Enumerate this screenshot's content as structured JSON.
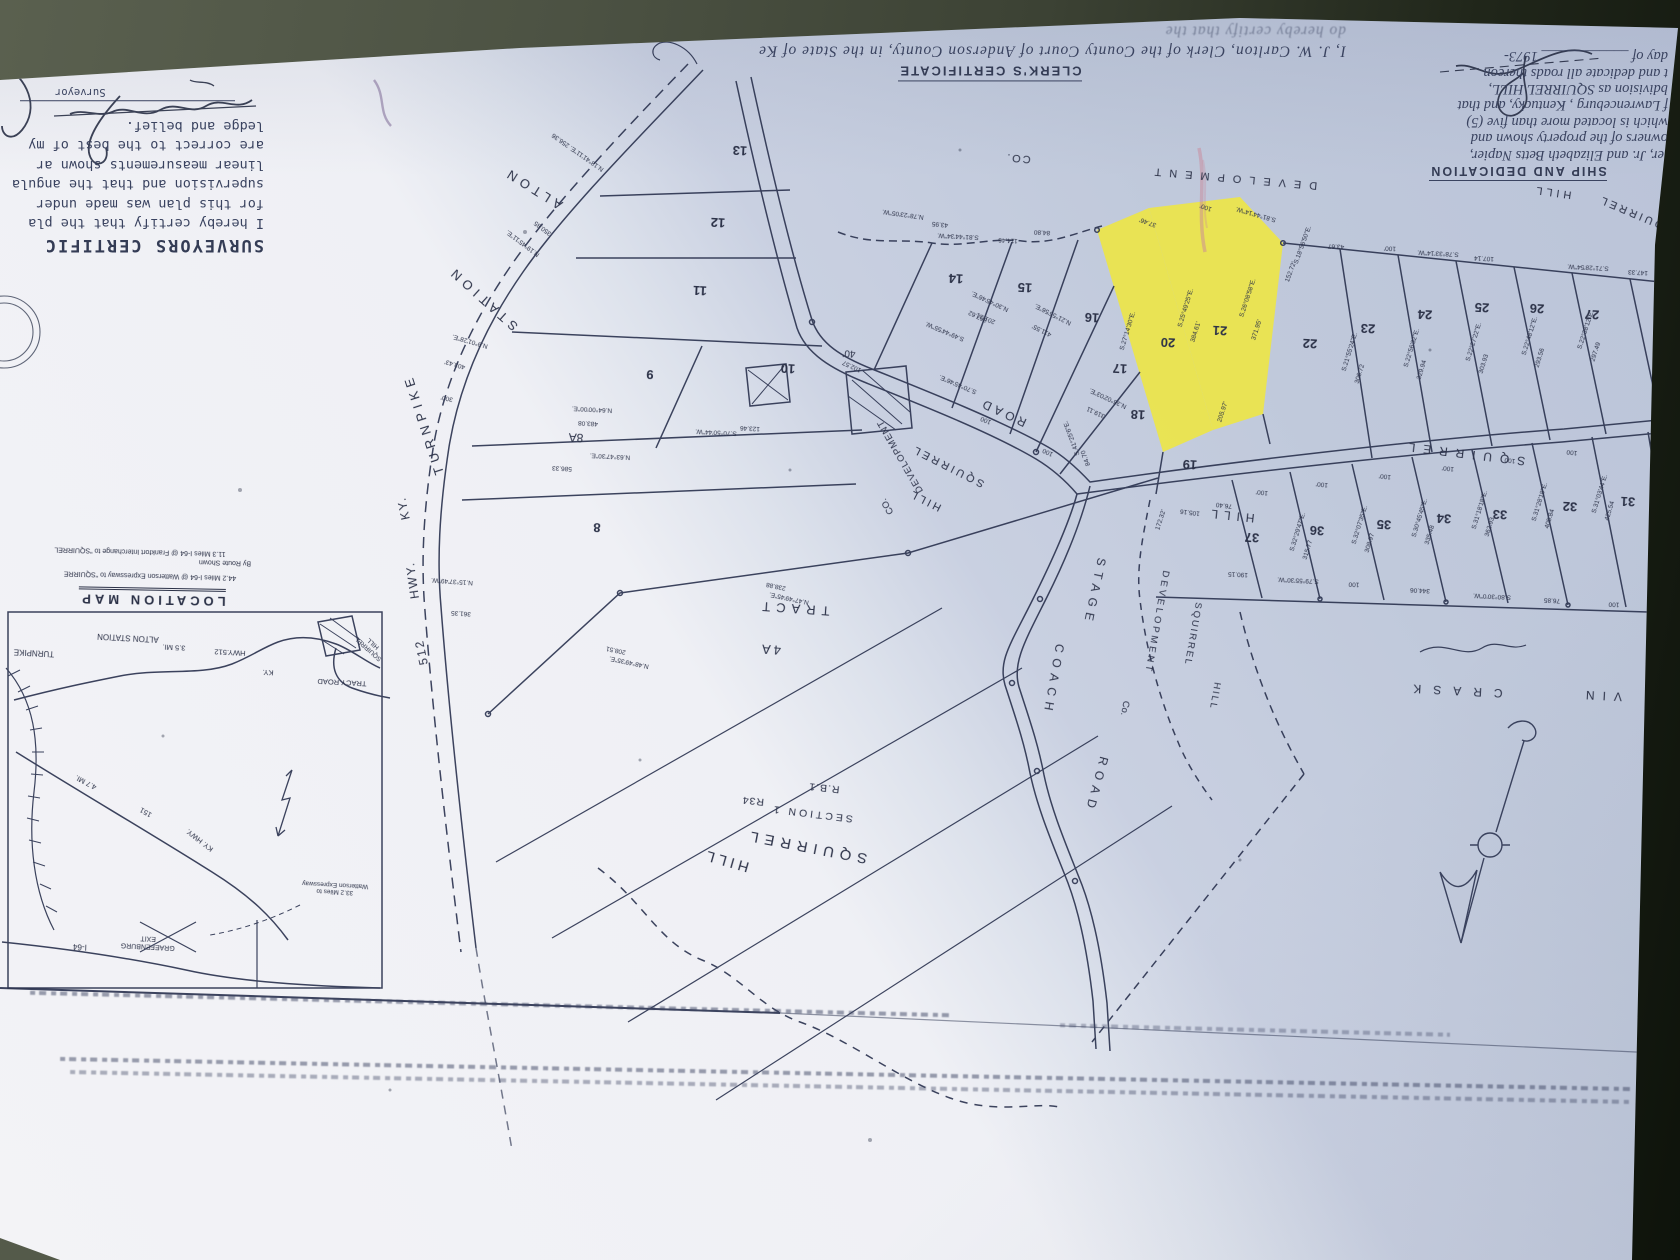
{
  "colors": {
    "paper_light": "#f3f3f6",
    "paper_shadow": "#bac3d8",
    "ink": "#2b3147",
    "highlight": "#f0e83c",
    "background_olive": "#4c5243",
    "pink_mark": "#c9879a",
    "purple_mark": "#7d6a96"
  },
  "certificates": {
    "surveyor": {
      "heading": "SURVEYORS CERTIFIC",
      "lines": [
        "I hereby certify that the pla",
        "for this plan was made under",
        "supervision and that the angula",
        "linear measurements shown ar",
        "are correct to the best of my",
        "ledge and belief."
      ],
      "signature_label": "Surveyor"
    },
    "clerk": {
      "heading": "CLERK'S CERTIFICATE",
      "lines": [
        "I, J. W. Carlton, Clerk of the County Court of Anderson County, in the State of Ke",
        "do hereby certify that the"
      ]
    },
    "dedication": {
      "heading": "SHIP AND DEDICATION",
      "lines": [
        "ler, Jr. and Elizabeth Betts Napier,",
        "owners of the property shown and",
        "which is located more than five (5)",
        "f Lawrenceburg , Kentucky, and that",
        "bdivision as SQUIRREL HILL,",
        "t and dedicate all roads thereon"
      ],
      "date_line": "day of ____________ 1973-"
    }
  },
  "location_map": {
    "labels": [
      {
        "t": "LOCATION MAP",
        "x": 152,
        "y": 597,
        "r": 181,
        "s": 13,
        "sp": 4,
        "b": 1,
        "u": 1,
        "dn": "location-map-title"
      },
      {
        "t": "11.3 Miles I-64 @ Frankfort Interchange to \"SQUIRREL",
        "x": 140,
        "y": 551,
        "r": 181.5,
        "s": 7
      },
      {
        "t": "By Route Shown",
        "x": 225,
        "y": 562,
        "r": 181.5,
        "s": 7
      },
      {
        "t": "44.2 Miles I-64 @ Watterson Expressway to \"SQUIRRE",
        "x": 150,
        "y": 575,
        "r": 181.5,
        "s": 7
      },
      {
        "t": "TURNPIKE",
        "x": 34,
        "y": 652,
        "s": 8
      },
      {
        "t": "ALTON STATION",
        "x": 128,
        "y": 637,
        "s": 8
      },
      {
        "t": "3.5 MI.",
        "x": 174,
        "y": 647,
        "s": 7.5
      },
      {
        "t": "HWY.512",
        "x": 230,
        "y": 652,
        "s": 7.5
      },
      {
        "t": "KY.",
        "x": 268,
        "y": 672,
        "s": 7.5
      },
      {
        "t": "TRACY ROAD",
        "x": 342,
        "y": 682,
        "s": 7.5
      },
      {
        "t": "SQUIRREL\nHILL",
        "x": 371,
        "y": 646,
        "r": 222,
        "s": 6.5,
        "nl": 1
      },
      {
        "t": "KY. HWY.",
        "x": 200,
        "y": 840,
        "r": 218,
        "s": 7.5
      },
      {
        "t": "151",
        "x": 146,
        "y": 812,
        "r": 210,
        "s": 7.5
      },
      {
        "t": "4.7 MI.",
        "x": 86,
        "y": 782,
        "r": 208,
        "s": 7.5
      },
      {
        "t": "I-64",
        "x": 80,
        "y": 946,
        "s": 8
      },
      {
        "t": "GRAEFENBURG\nEXIT",
        "x": 148,
        "y": 942,
        "s": 7,
        "nl": 1
      },
      {
        "t": "33.2 Miles to\nWatterson Expressway",
        "x": 335,
        "y": 888,
        "s": 6.5,
        "nl": 1
      }
    ]
  },
  "plat": {
    "highlighted_lots": [
      "20",
      "21"
    ],
    "labels": [
      {
        "t": "ALTON",
        "x": 533,
        "y": 188,
        "r": 212,
        "s": 13,
        "sp": 5
      },
      {
        "t": "STATION",
        "x": 483,
        "y": 298,
        "r": 222,
        "s": 13,
        "sp": 5
      },
      {
        "t": "TURNPIKE",
        "x": 424,
        "y": 424,
        "r": 252,
        "s": 13,
        "sp": 5
      },
      {
        "t": "KY.",
        "x": 404,
        "y": 508,
        "r": 258,
        "s": 12,
        "sp": 2
      },
      {
        "t": "HWY.",
        "x": 413,
        "y": 580,
        "r": 262,
        "s": 12,
        "sp": 2
      },
      {
        "t": "512",
        "x": 422,
        "y": 652,
        "r": 258,
        "s": 12,
        "sp": 2
      },
      {
        "t": "ROAD",
        "x": 1003,
        "y": 412,
        "r": 205,
        "s": 12,
        "sp": 4
      },
      {
        "t": "SQUIRREL",
        "x": 948,
        "y": 466,
        "r": 207,
        "s": 11,
        "sp": 3
      },
      {
        "t": "HILL",
        "x": 925,
        "y": 500,
        "r": 207,
        "s": 11,
        "sp": 3
      },
      {
        "t": "DEVELOPMENT",
        "x": 901,
        "y": 456,
        "r": 240,
        "s": 9.5,
        "sp": 1
      },
      {
        "t": "CO.",
        "x": 888,
        "y": 506,
        "r": 240,
        "s": 9.5
      },
      {
        "t": "STAGE",
        "x": 1094,
        "y": 592,
        "r": 102,
        "s": 12,
        "sp": 6
      },
      {
        "t": "COACH",
        "x": 1053,
        "y": 680,
        "r": 100,
        "s": 12,
        "sp": 6
      },
      {
        "t": "ROAD",
        "x": 1096,
        "y": 785,
        "r": 105,
        "s": 12,
        "sp": 6
      },
      {
        "t": "SQUIRREL",
        "x": 1463,
        "y": 453,
        "r": 187,
        "s": 12,
        "sp": 8
      },
      {
        "t": "HILL",
        "x": 1230,
        "y": 515,
        "r": 186,
        "s": 12,
        "sp": 6
      },
      {
        "t": "DEVELOPMENT",
        "x": 1156,
        "y": 622,
        "r": 100,
        "s": 9.5,
        "sp": 3
      },
      {
        "t": "Co.",
        "x": 1124,
        "y": 708,
        "r": 100,
        "s": 9.5
      },
      {
        "t": "SQUIRREL",
        "x": 1192,
        "y": 634,
        "r": 100,
        "s": 9.5,
        "sp": 2
      },
      {
        "t": "HILL",
        "x": 1214,
        "y": 696,
        "r": 100,
        "s": 9.5,
        "sp": 2
      },
      {
        "t": "DEVELOPMENT",
        "x": 1232,
        "y": 178,
        "r": 185,
        "s": 11,
        "sp": 8
      },
      {
        "t": "CO.",
        "x": 1018,
        "y": 158,
        "r": 185,
        "s": 11,
        "sp": 2
      },
      {
        "t": "HILL",
        "x": 1552,
        "y": 192,
        "r": 188,
        "s": 11,
        "sp": 4
      },
      {
        "t": "SQUIRREL",
        "x": 1636,
        "y": 214,
        "r": 203,
        "s": 11,
        "sp": 3
      },
      {
        "t": "CRASK",
        "x": 1452,
        "y": 690,
        "r": 183,
        "s": 12,
        "sp": 12
      },
      {
        "t": "VIN",
        "x": 1600,
        "y": 695,
        "r": 183,
        "s": 12,
        "sp": 8
      },
      {
        "t": "TRACT",
        "x": 793,
        "y": 608,
        "r": 184,
        "s": 13,
        "sp": 6
      },
      {
        "t": "4A",
        "x": 770,
        "y": 649,
        "r": 184,
        "s": 13,
        "sp": 3
      },
      {
        "t": "SQUIRREL",
        "x": 806,
        "y": 846,
        "r": 191,
        "s": 15,
        "sp": 6,
        "dn": "subdivision-title"
      },
      {
        "t": "HILL",
        "x": 726,
        "y": 860,
        "r": 196,
        "s": 15,
        "sp": 4,
        "dn": "subdivision-title"
      },
      {
        "t": "SECTION 1",
        "x": 812,
        "y": 813,
        "r": 187,
        "s": 10.5,
        "sp": 3
      },
      {
        "t": "R.B.1",
        "x": 824,
        "y": 787,
        "r": 186,
        "s": 10.5,
        "sp": 1
      },
      {
        "t": "R34",
        "x": 753,
        "y": 800,
        "r": 186,
        "s": 10.5,
        "sp": 1
      },
      {
        "t": "40'",
        "x": 849,
        "y": 353,
        "r": 184,
        "s": 10
      },
      {
        "t": "8A",
        "x": 576,
        "y": 437,
        "r": 183,
        "s": 12
      }
    ],
    "lots": [
      {
        "n": "8",
        "x": 597,
        "y": 527
      },
      {
        "n": "9",
        "x": 650,
        "y": 374
      },
      {
        "n": "10",
        "x": 788,
        "y": 368
      },
      {
        "n": "11",
        "x": 700,
        "y": 290
      },
      {
        "n": "12",
        "x": 718,
        "y": 222
      },
      {
        "n": "13",
        "x": 740,
        "y": 150
      },
      {
        "n": "14",
        "x": 956,
        "y": 278
      },
      {
        "n": "15",
        "x": 1025,
        "y": 287
      },
      {
        "n": "16",
        "x": 1092,
        "y": 317
      },
      {
        "n": "17",
        "x": 1120,
        "y": 368
      },
      {
        "n": "18",
        "x": 1138,
        "y": 414
      },
      {
        "n": "19",
        "x": 1190,
        "y": 464
      },
      {
        "n": "20",
        "x": 1168,
        "y": 342
      },
      {
        "n": "21",
        "x": 1220,
        "y": 330
      },
      {
        "n": "22",
        "x": 1310,
        "y": 343
      },
      {
        "n": "23",
        "x": 1368,
        "y": 328
      },
      {
        "n": "24",
        "x": 1425,
        "y": 314
      },
      {
        "n": "25",
        "x": 1482,
        "y": 307
      },
      {
        "n": "26",
        "x": 1537,
        "y": 308
      },
      {
        "n": "27",
        "x": 1592,
        "y": 314
      },
      {
        "n": "31",
        "x": 1628,
        "y": 501
      },
      {
        "n": "32",
        "x": 1570,
        "y": 506
      },
      {
        "n": "33",
        "x": 1500,
        "y": 514
      },
      {
        "n": "34",
        "x": 1444,
        "y": 518
      },
      {
        "n": "35",
        "x": 1384,
        "y": 524
      },
      {
        "n": "36",
        "x": 1317,
        "y": 530
      },
      {
        "n": "37",
        "x": 1252,
        "y": 537
      }
    ],
    "bearings": [
      {
        "t": "N.19°45'11\"E.",
        "x": 523,
        "y": 243,
        "r": 217
      },
      {
        "t": "350.85",
        "x": 543,
        "y": 228,
        "r": 217
      },
      {
        "t": "N.9°01'28\"E.",
        "x": 470,
        "y": 341,
        "r": 196
      },
      {
        "t": "403.43'",
        "x": 455,
        "y": 364,
        "r": 196
      },
      {
        "t": "300'",
        "x": 447,
        "y": 398,
        "r": 193
      },
      {
        "t": "N.15°37'49\"W.",
        "x": 452,
        "y": 581,
        "r": 184
      },
      {
        "t": "361.35",
        "x": 461,
        "y": 613,
        "r": 184
      },
      {
        "t": "N.18°41'11\"E. 256.36",
        "x": 578,
        "y": 152,
        "r": 215
      },
      {
        "t": "N.64°00'00\"E.",
        "x": 592,
        "y": 409
      },
      {
        "t": "483.08",
        "x": 588,
        "y": 423
      },
      {
        "t": "586.33",
        "x": 562,
        "y": 468
      },
      {
        "t": "N.63°47'30\"E.",
        "x": 610,
        "y": 456
      },
      {
        "t": "N.47°49'45\"E.",
        "x": 789,
        "y": 598,
        "r": 192
      },
      {
        "t": "238.88",
        "x": 776,
        "y": 586,
        "r": 192
      },
      {
        "t": "N.48°49'35\"E.",
        "x": 629,
        "y": 662,
        "r": 192
      },
      {
        "t": "208.51",
        "x": 616,
        "y": 650,
        "r": 192
      },
      {
        "t": "S.70°50'44\"W.",
        "x": 716,
        "y": 432
      },
      {
        "t": "123.46",
        "x": 750,
        "y": 428
      },
      {
        "t": "S.81°44'34\"W.",
        "x": 958,
        "y": 236
      },
      {
        "t": "114.46",
        "x": 1008,
        "y": 240
      },
      {
        "t": "N.78°23'05\"W.",
        "x": 903,
        "y": 214,
        "r": 188
      },
      {
        "t": "43.95",
        "x": 940,
        "y": 224,
        "r": 186
      },
      {
        "t": "84.80",
        "x": 1042,
        "y": 232
      },
      {
        "t": "37.46'",
        "x": 1148,
        "y": 222,
        "r": 200
      },
      {
        "t": "100'",
        "x": 1206,
        "y": 207,
        "r": 200
      },
      {
        "t": "S.81°44'14\"W.",
        "x": 1256,
        "y": 214,
        "r": 196
      },
      {
        "t": "152.72'",
        "x": 1291,
        "y": 272,
        "r": 290
      },
      {
        "t": "S.18°56'50\"E.",
        "x": 1303,
        "y": 245,
        "r": 290
      },
      {
        "t": "S.25°49'25\"E.",
        "x": 1186,
        "y": 308,
        "r": 287
      },
      {
        "t": "384.61'",
        "x": 1196,
        "y": 332,
        "r": 287
      },
      {
        "t": "S.26°08'58\"E.",
        "x": 1248,
        "y": 298,
        "r": 288
      },
      {
        "t": "371.95'",
        "x": 1257,
        "y": 330,
        "r": 288
      },
      {
        "t": "S.27°14'30\"E.",
        "x": 1128,
        "y": 331,
        "r": 287
      },
      {
        "t": "205.97'",
        "x": 1223,
        "y": 412,
        "r": 288
      },
      {
        "t": "172.32'",
        "x": 1161,
        "y": 520,
        "r": 288
      },
      {
        "t": "S.78°33'14\"W.",
        "x": 1438,
        "y": 253
      },
      {
        "t": "107.14",
        "x": 1484,
        "y": 258
      },
      {
        "t": "100'",
        "x": 1390,
        "y": 248
      },
      {
        "t": "43.67",
        "x": 1336,
        "y": 246
      },
      {
        "t": "S.71°28'54\"W.",
        "x": 1588,
        "y": 267
      },
      {
        "t": "147.33",
        "x": 1638,
        "y": 272
      },
      {
        "t": "S.21°55'24\"E.",
        "x": 1350,
        "y": 352,
        "r": 287
      },
      {
        "t": "306.72",
        "x": 1360,
        "y": 374,
        "r": 287
      },
      {
        "t": "S.22°56'32\"E.",
        "x": 1412,
        "y": 348,
        "r": 287
      },
      {
        "t": "329.94",
        "x": 1422,
        "y": 370,
        "r": 287
      },
      {
        "t": "S.22°27'22\"E.",
        "x": 1474,
        "y": 342,
        "r": 287
      },
      {
        "t": "303.93",
        "x": 1484,
        "y": 364,
        "r": 287
      },
      {
        "t": "S.22°48'12\"E.",
        "x": 1530,
        "y": 336,
        "r": 287
      },
      {
        "t": "293.56",
        "x": 1540,
        "y": 358,
        "r": 287
      },
      {
        "t": "S.22°38'12\"E.",
        "x": 1586,
        "y": 330,
        "r": 288
      },
      {
        "t": "297.49",
        "x": 1596,
        "y": 352,
        "r": 288
      },
      {
        "t": "N.30°45'46\"E.",
        "x": 990,
        "y": 301,
        "r": 205
      },
      {
        "t": "367.62",
        "x": 978,
        "y": 316,
        "r": 205
      },
      {
        "t": "N.21°55'56\"E.",
        "x": 1053,
        "y": 314,
        "r": 207
      },
      {
        "t": "411.55'",
        "x": 1042,
        "y": 330,
        "r": 207
      },
      {
        "t": "N.36°02'03\"E.",
        "x": 1108,
        "y": 398,
        "r": 205
      },
      {
        "t": "319.11",
        "x": 1096,
        "y": 412,
        "r": 205
      },
      {
        "t": "S.70°45'46\"E.",
        "x": 958,
        "y": 384,
        "r": 203
      },
      {
        "t": "100",
        "x": 986,
        "y": 420,
        "r": 203
      },
      {
        "t": "100",
        "x": 1048,
        "y": 452,
        "r": 205
      },
      {
        "t": "S.41°25'6\"E.",
        "x": 1072,
        "y": 438,
        "r": 250
      },
      {
        "t": "84.70",
        "x": 1086,
        "y": 458,
        "r": 250
      },
      {
        "t": "S.49°44'55\"W.",
        "x": 945,
        "y": 331,
        "r": 203
      },
      {
        "t": "201.31",
        "x": 986,
        "y": 318,
        "r": 203
      },
      {
        "t": "102.57",
        "x": 852,
        "y": 366,
        "r": 205
      },
      {
        "t": "100'",
        "x": 1262,
        "y": 492,
        "r": 187
      },
      {
        "t": "100'",
        "x": 1322,
        "y": 484,
        "r": 187
      },
      {
        "t": "100'",
        "x": 1385,
        "y": 476,
        "r": 187
      },
      {
        "t": "100'",
        "x": 1448,
        "y": 468,
        "r": 187
      },
      {
        "t": "100",
        "x": 1510,
        "y": 460,
        "r": 187
      },
      {
        "t": "100",
        "x": 1572,
        "y": 452,
        "r": 187
      },
      {
        "t": "105.16",
        "x": 1190,
        "y": 512,
        "r": 187
      },
      {
        "t": "76.40",
        "x": 1224,
        "y": 505,
        "r": 187
      },
      {
        "t": "S.32°29'47\"E.",
        "x": 1298,
        "y": 532,
        "r": 287
      },
      {
        "t": "315.77",
        "x": 1308,
        "y": 550,
        "r": 287
      },
      {
        "t": "S.32°07'35\"E.",
        "x": 1360,
        "y": 525,
        "r": 287
      },
      {
        "t": "308.97",
        "x": 1370,
        "y": 543,
        "r": 287
      },
      {
        "t": "S.30°45'45\"E.",
        "x": 1420,
        "y": 518,
        "r": 287
      },
      {
        "t": "335.48",
        "x": 1430,
        "y": 535,
        "r": 287
      },
      {
        "t": "S.31°18'18\"E.",
        "x": 1480,
        "y": 510,
        "r": 287
      },
      {
        "t": "362.93",
        "x": 1490,
        "y": 527,
        "r": 287
      },
      {
        "t": "S.31°28'18\"E.",
        "x": 1540,
        "y": 502,
        "r": 287
      },
      {
        "t": "405.84",
        "x": 1550,
        "y": 519,
        "r": 287
      },
      {
        "t": "S.31°03'44\"E.",
        "x": 1600,
        "y": 494,
        "r": 287
      },
      {
        "t": "425.54",
        "x": 1610,
        "y": 511,
        "r": 287
      },
      {
        "t": "190.15",
        "x": 1238,
        "y": 574
      },
      {
        "t": "S.79°55'30\"W.",
        "x": 1298,
        "y": 580
      },
      {
        "t": "100",
        "x": 1354,
        "y": 584
      },
      {
        "t": "344.06",
        "x": 1420,
        "y": 590
      },
      {
        "t": "S.80°30'0\"W.",
        "x": 1492,
        "y": 596
      },
      {
        "t": "76.85",
        "x": 1552,
        "y": 600
      },
      {
        "t": "100",
        "x": 1614,
        "y": 604
      },
      {
        "t": "214.94",
        "x": 1660,
        "y": 608
      }
    ]
  }
}
